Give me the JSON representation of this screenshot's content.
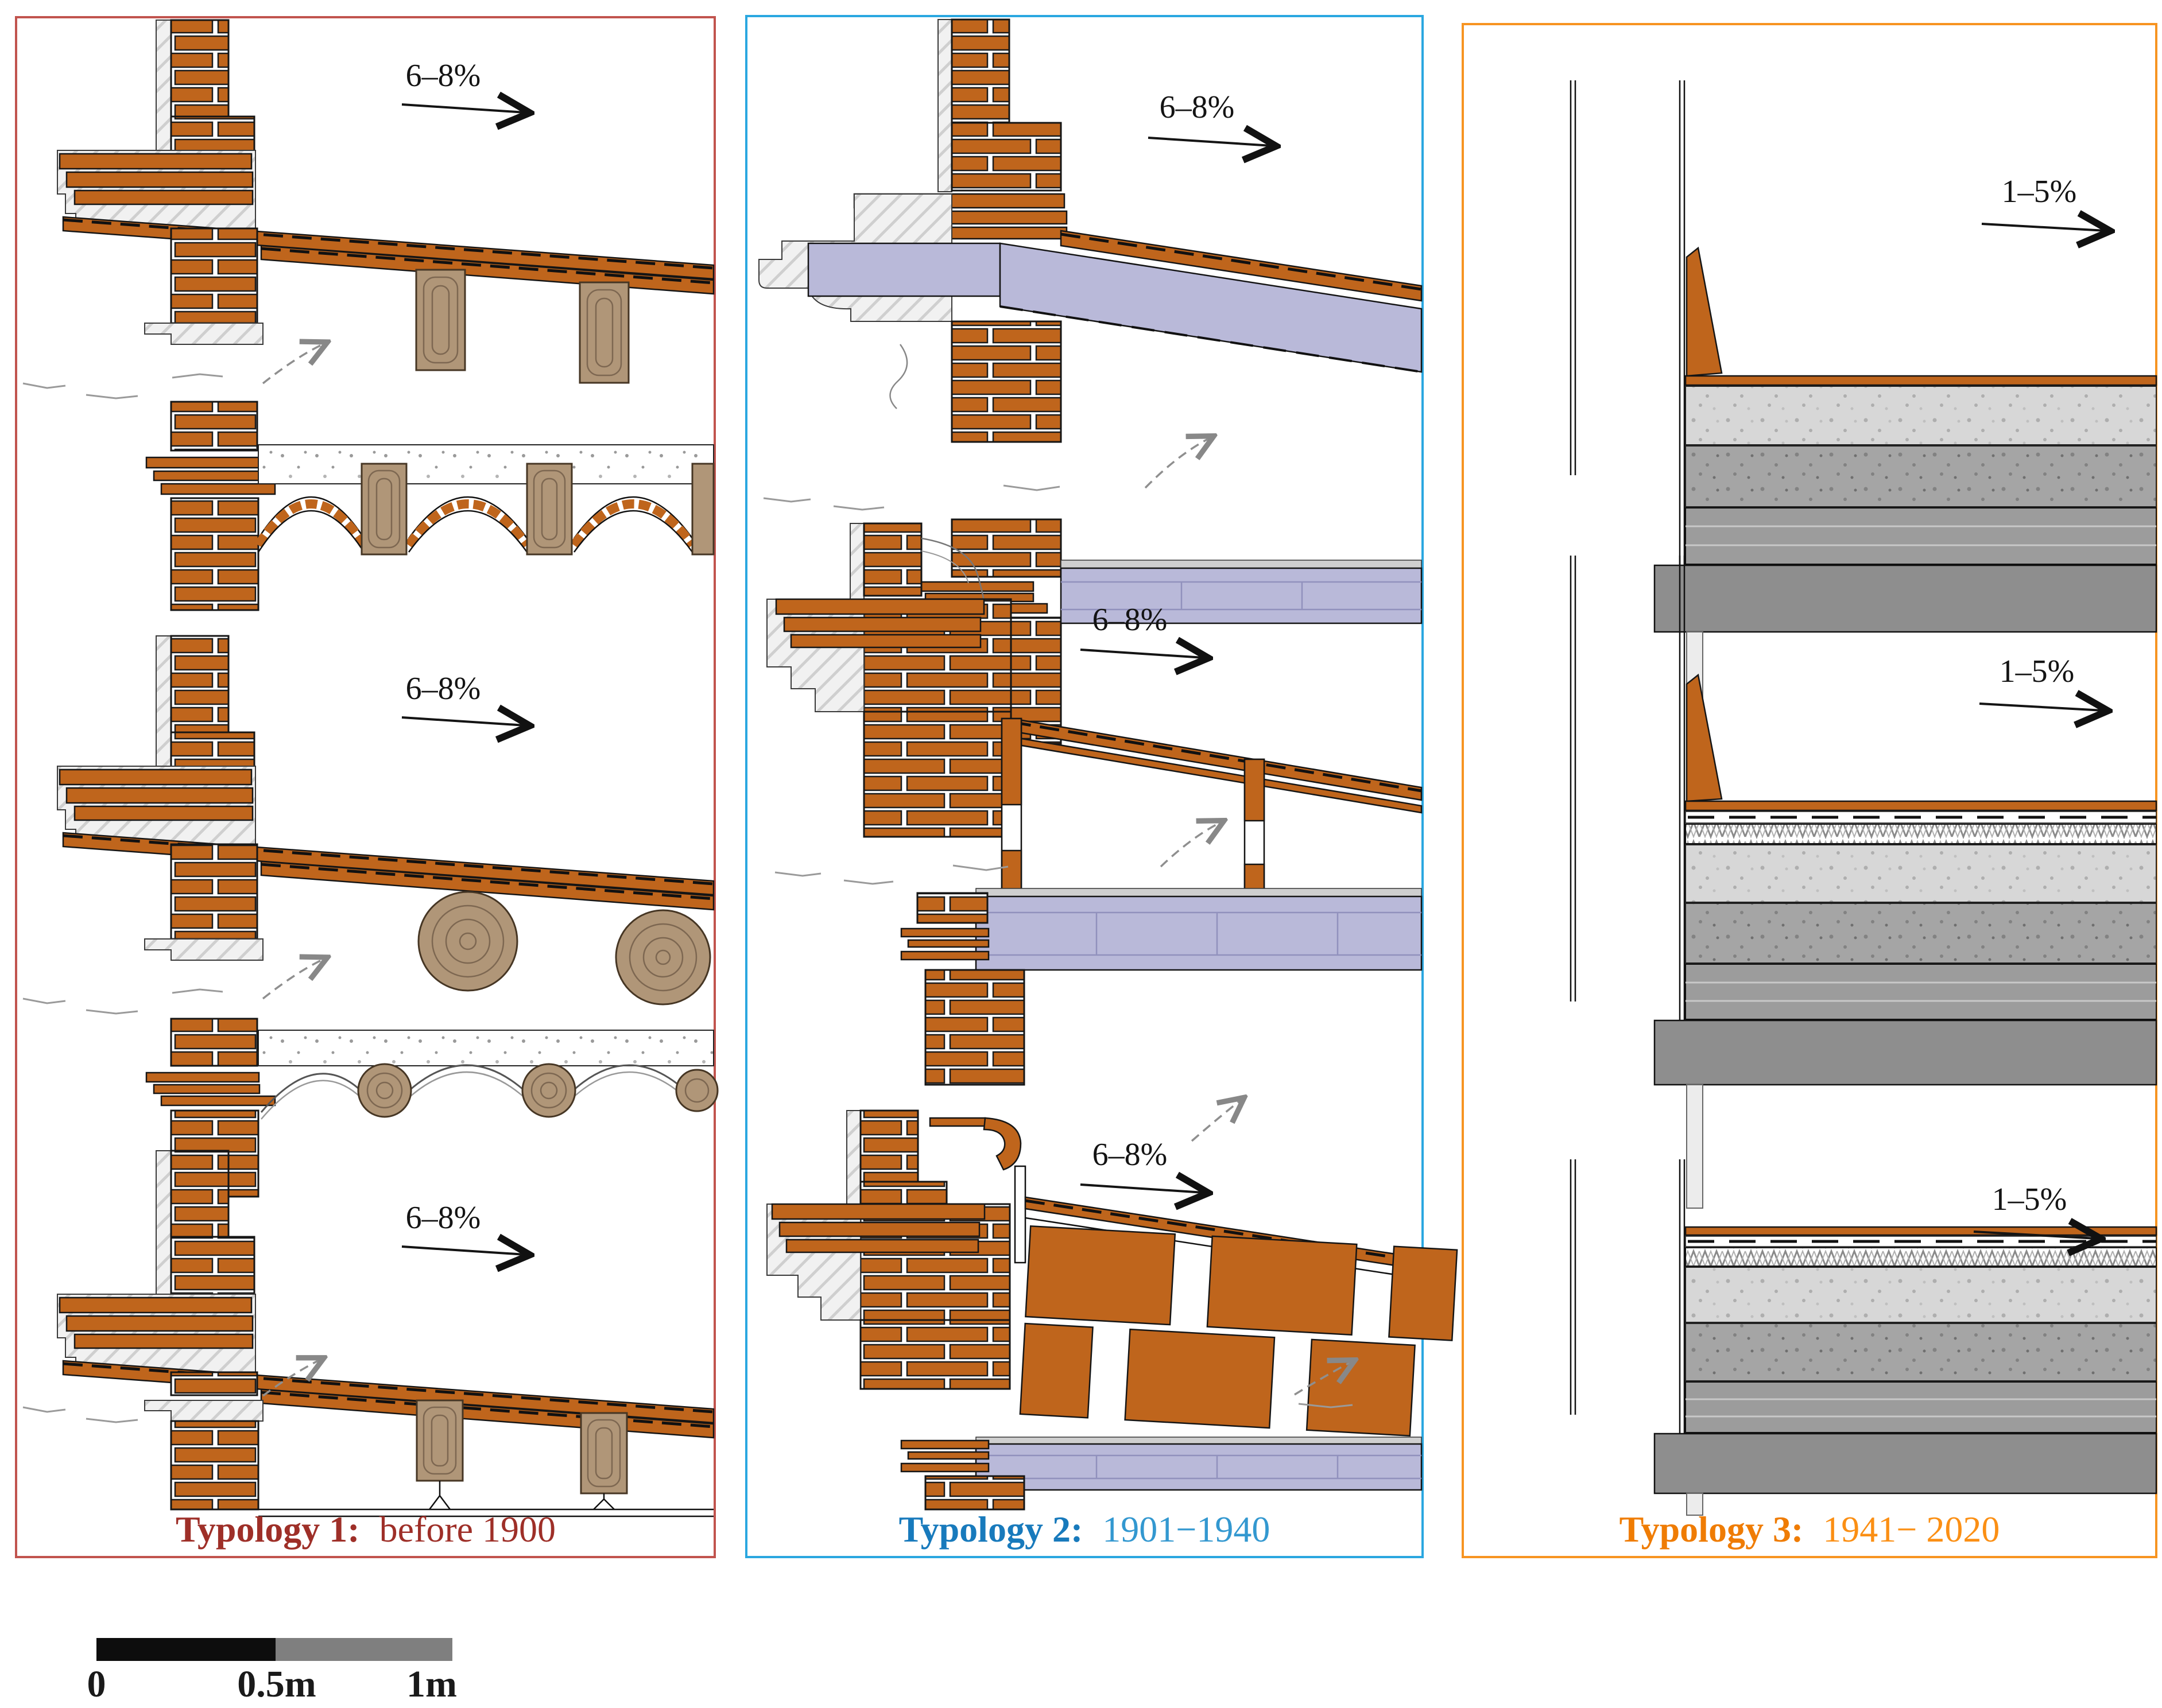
{
  "figure": {
    "description": "Three roof-eaves construction detail typologies",
    "panels": [
      {
        "title_bold": "Typology 1:",
        "title_rest": "before 1900",
        "border_color": "#c1544e",
        "title_color_bold": "#9e2f28",
        "title_color_rest": "#9e2f28",
        "slope_labels": [
          "6–8%",
          "6–8%",
          "6–8%"
        ]
      },
      {
        "title_bold": "Typology 2:",
        "title_rest": "1901−1940",
        "border_color": "#2aa7e0",
        "title_color_bold": "#187abc",
        "title_color_rest": "#3398d0",
        "slope_labels": [
          "6–8%",
          "6–8%",
          "6–8%"
        ]
      },
      {
        "title_bold": "Typology 3:",
        "title_rest": "1941− 2020",
        "border_color": "#f79421",
        "title_color_bold": "#ef7c04",
        "title_color_rest": "#fb8f14",
        "slope_labels": [
          "1–5%",
          "1–5%",
          "1–5%"
        ]
      }
    ],
    "scale_bar": {
      "labels": [
        "0",
        "0.5m",
        "1m"
      ]
    },
    "materials_colors": {
      "brick_tile": "#bf651c",
      "timber": "#b09678",
      "early_concrete": "#b9b9d9",
      "screed_light": "#d7d7d7",
      "modern_concrete": "#a5a5a5",
      "slab_gray": "#9c9c9c",
      "beam_gray": "#8e8e8e"
    }
  }
}
